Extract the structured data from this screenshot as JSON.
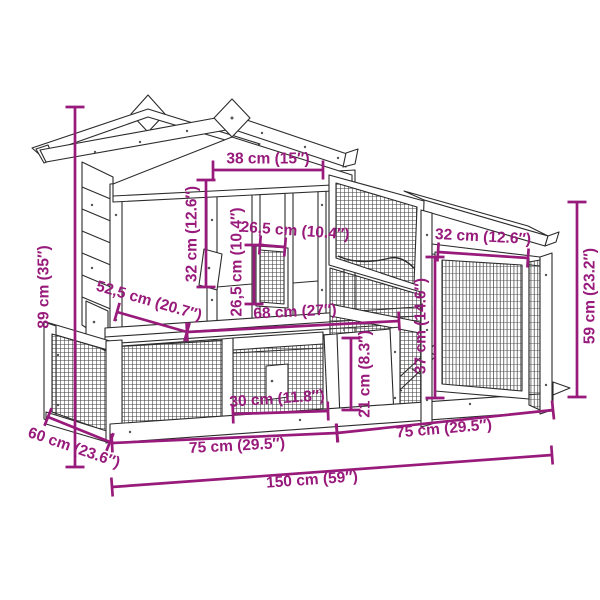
{
  "page": {
    "background": "#ffffff"
  },
  "diagram": {
    "type": "product-dimension-diagram",
    "subject": "wooden rabbit hutch with run and side annex",
    "accent_color": "#981A7B",
    "line_color": "#2b2b2b"
  },
  "dimensions": {
    "total_width": {
      "label": "150 cm (59″)"
    },
    "total_height": {
      "label": "89 cm (35″)"
    },
    "total_depth": {
      "label": "60 cm (23.6″)"
    },
    "base_left_width": {
      "label": "75 cm (29.5″)"
    },
    "base_right_width": {
      "label": "75 cm (29.5″)"
    },
    "roof_front_width": {
      "label": "38 cm (15″)"
    },
    "left_panel_height": {
      "label": "32 cm (12.6″)"
    },
    "hatch_width": {
      "label": "26,5 cm (10.4″)"
    },
    "hatch_height": {
      "label": "26,5 cm (10.4″)"
    },
    "upper_level_depth": {
      "label": "52,5 cm (20.7″)"
    },
    "upper_level_width": {
      "label": "68 cm (27″)"
    },
    "run_door_width": {
      "label": "30 cm (11.8″)"
    },
    "run_door_height": {
      "label": "21 cm (8.3″)"
    },
    "annex_door_width": {
      "label": "32 cm (12.6″)"
    },
    "annex_door_height": {
      "label": "37 cm (14.6″)"
    },
    "annex_height": {
      "label": "59 cm (23.2″)"
    }
  }
}
